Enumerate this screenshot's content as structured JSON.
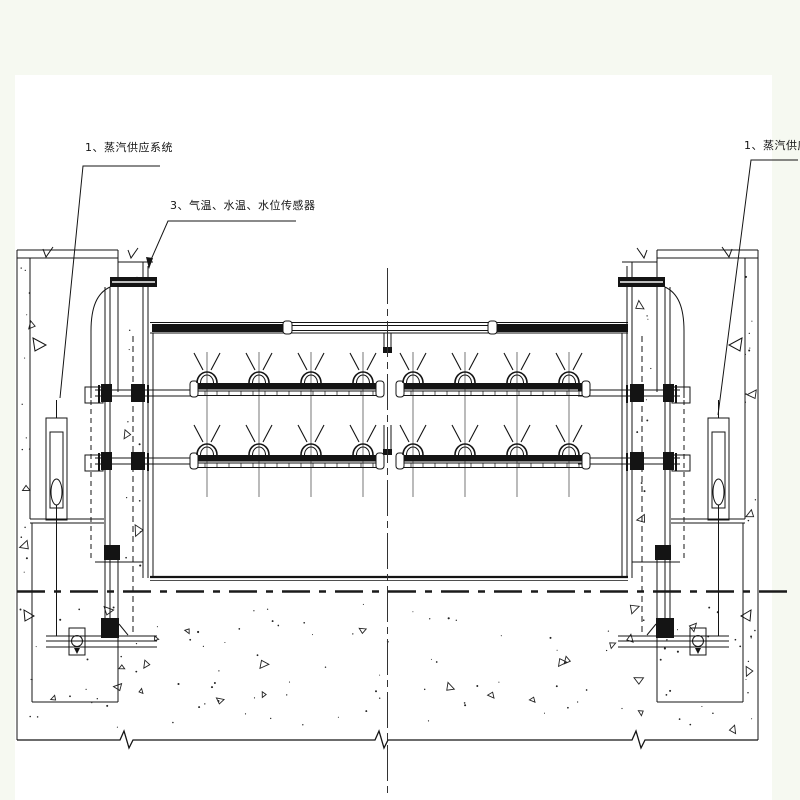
{
  "drawing": {
    "type": "engineering-section-gate-heating-system",
    "labels": {
      "steam_supply_left": "1、蒸汽供应系统",
      "sensors": "3、气温、水温、水位传感器",
      "steam_supply_right": "1、蒸汽供应系统"
    },
    "colors": {
      "paper": "#ffffff",
      "margin": "#f6f9f1",
      "ink": "#141414"
    }
  }
}
